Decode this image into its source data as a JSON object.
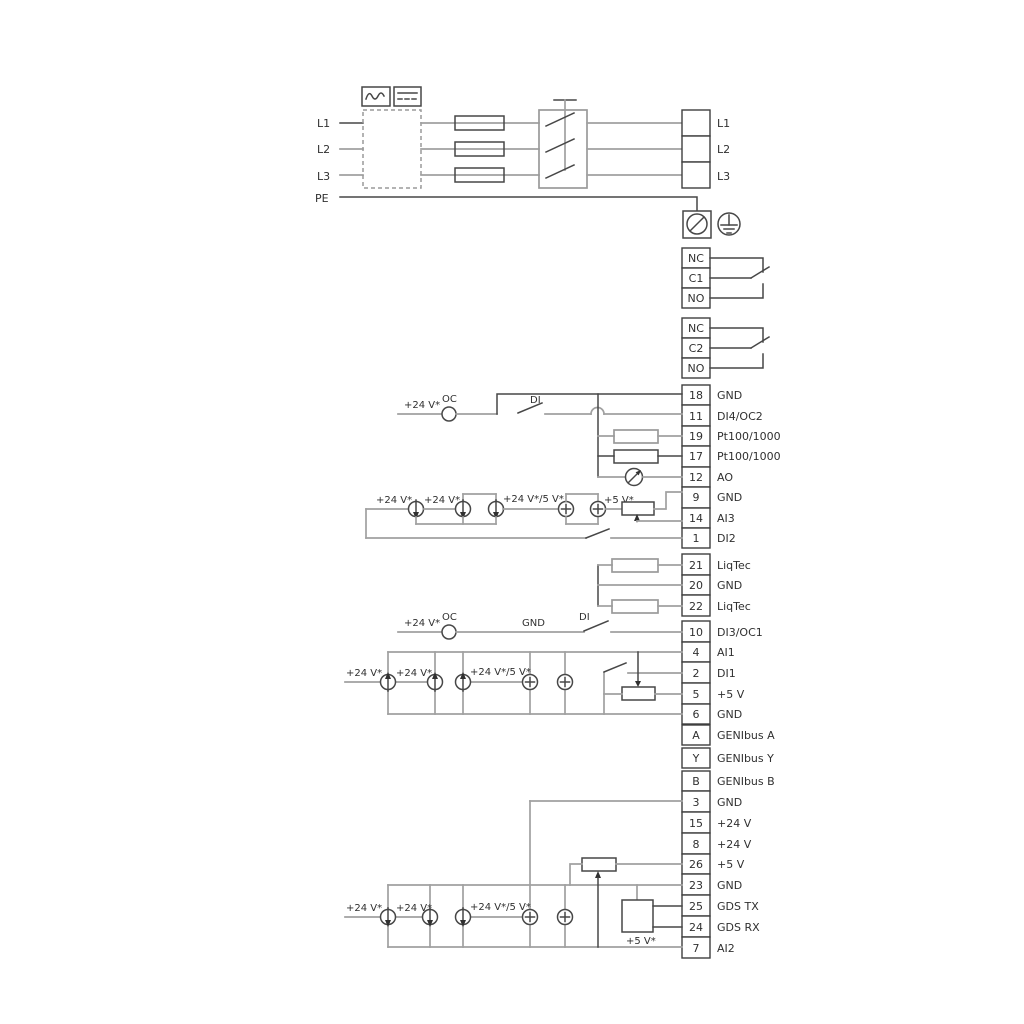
{
  "diagram": {
    "mains": {
      "inputs": [
        "L1",
        "L2",
        "L3",
        "PE"
      ],
      "outputs": [
        "L1",
        "L2",
        "L3"
      ]
    },
    "relay1": [
      "NC",
      "C1",
      "NO"
    ],
    "relay2": [
      "NC",
      "C2",
      "NO"
    ],
    "blockA": [
      {
        "num": "18",
        "label": "GND"
      },
      {
        "num": "11",
        "label": "DI4/OC2"
      },
      {
        "num": "19",
        "label": "Pt100/1000"
      },
      {
        "num": "17",
        "label": "Pt100/1000"
      },
      {
        "num": "12",
        "label": "AO"
      },
      {
        "num": "9",
        "label": "GND"
      },
      {
        "num": "14",
        "label": "AI3"
      },
      {
        "num": "1",
        "label": "DI2"
      }
    ],
    "blockB": [
      {
        "num": "21",
        "label": "LiqTec"
      },
      {
        "num": "20",
        "label": "GND"
      },
      {
        "num": "22",
        "label": "LiqTec"
      }
    ],
    "blockC": [
      {
        "num": "10",
        "label": "DI3/OC1"
      },
      {
        "num": "4",
        "label": "AI1"
      },
      {
        "num": "2",
        "label": "DI1"
      },
      {
        "num": "5",
        "label": "+5 V"
      },
      {
        "num": "6",
        "label": "GND"
      }
    ],
    "blockD": [
      {
        "num": "A",
        "label": "GENIbus A"
      },
      {
        "num": "Y",
        "label": "GENIbus Y"
      },
      {
        "num": "B",
        "label": "GENIbus B"
      }
    ],
    "blockE": [
      {
        "num": "3",
        "label": "GND"
      },
      {
        "num": "15",
        "label": "+24 V"
      },
      {
        "num": "8",
        "label": "+24 V"
      },
      {
        "num": "26",
        "label": "+5 V"
      },
      {
        "num": "23",
        "label": "GND"
      },
      {
        "num": "25",
        "label": "GDS TX"
      },
      {
        "num": "24",
        "label": "GDS RX"
      },
      {
        "num": "7",
        "label": "AI2"
      }
    ],
    "ann": {
      "v24": "+24 V*",
      "v24_5": "+24 V*/5 V*",
      "v5": "+5 V*",
      "oc": "OC",
      "di": "DI",
      "gnd": "GND"
    },
    "icons": {
      "ac-symbol-icon": "sine-wave",
      "dc-symbol-icon": "solid-over-dashed-line",
      "fuse-icon": "rect-through-line",
      "disconnect-switch-icon": "three-pole-blades",
      "screw-terminal-icon": "circle-slash",
      "earth-ground-icon": "circle-ground-bars",
      "current-source-icon": "circle-arrow",
      "plus-source-icon": "circle-plus",
      "potentiometer-icon": "rect-with-wiper-arrow",
      "meter-icon": "circle-needle",
      "resistor-icon": "rect",
      "gds-sensor-icon": "square"
    },
    "colors": {
      "wire_grey": "#a0a0a0",
      "line_dark": "#474747",
      "text": "#303030",
      "background": "#ffffff"
    }
  }
}
